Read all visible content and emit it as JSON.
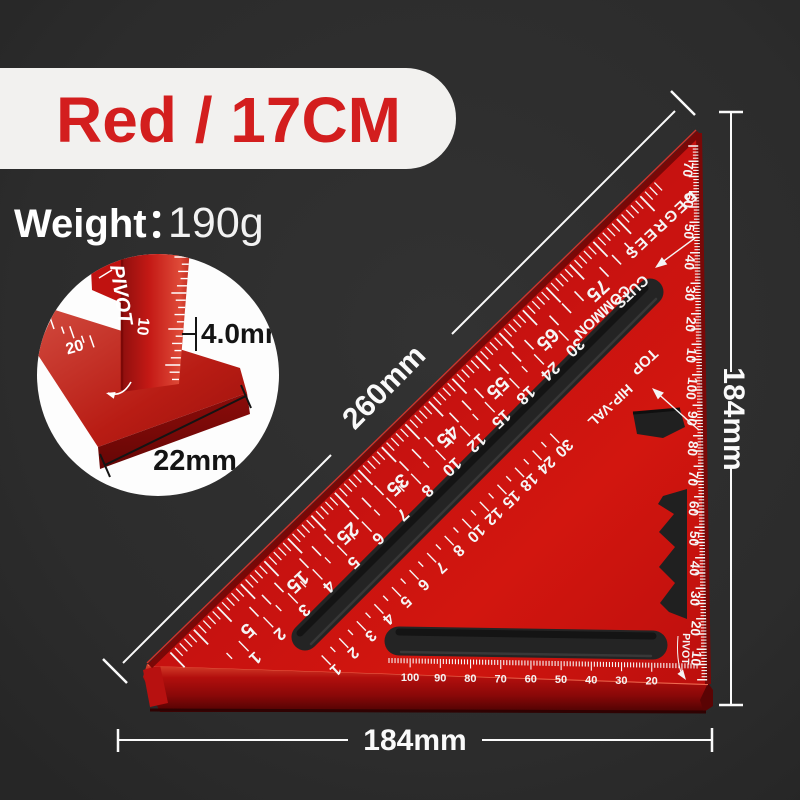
{
  "background": {
    "color": "#2d2d2d"
  },
  "title": {
    "text": "Red / 17CM",
    "color": "#d31e1e",
    "pill_color": "#f2f1ef"
  },
  "weight": {
    "label": "Weight：",
    "value": "190g"
  },
  "inset": {
    "thickness_label": "4.0mm",
    "width_label": "22mm",
    "blade_number": "10",
    "plate_number": "20",
    "pivot_label": "PIVOT"
  },
  "dimensions": {
    "hypotenuse": "260mm",
    "right_side": "184mm",
    "bottom_side": "184mm"
  },
  "square": {
    "color": "#c81210",
    "labels": {
      "degrees": "DEGREES",
      "cuts": "CUTS",
      "common": "COMMON",
      "top": "TOP",
      "hip_val": "HIP-VAL",
      "pivot": "PIVOT"
    },
    "scales": {
      "hypotenuse_degrees": [
        "5",
        "15",
        "25",
        "35",
        "45",
        "55",
        "65",
        "75"
      ],
      "common": [
        "30",
        "24",
        "18",
        "15",
        "12",
        "10",
        "8",
        "7",
        "6",
        "5",
        "4",
        "3",
        "2",
        "1"
      ],
      "hip_val": [
        "30",
        "24",
        "18",
        "15",
        "12",
        "10",
        "8",
        "7",
        "6",
        "5",
        "4",
        "3",
        "2",
        "1"
      ],
      "right_edge_degrees": [
        "70",
        "60",
        "50",
        "40",
        "30",
        "20",
        "10"
      ],
      "right_edge_mm": [
        "100",
        "90",
        "80",
        "70",
        "60",
        "50",
        "40",
        "30",
        "20",
        "10"
      ],
      "bottom_mm": [
        "100",
        "90",
        "80",
        "70",
        "60",
        "50",
        "40",
        "30",
        "20"
      ]
    }
  }
}
